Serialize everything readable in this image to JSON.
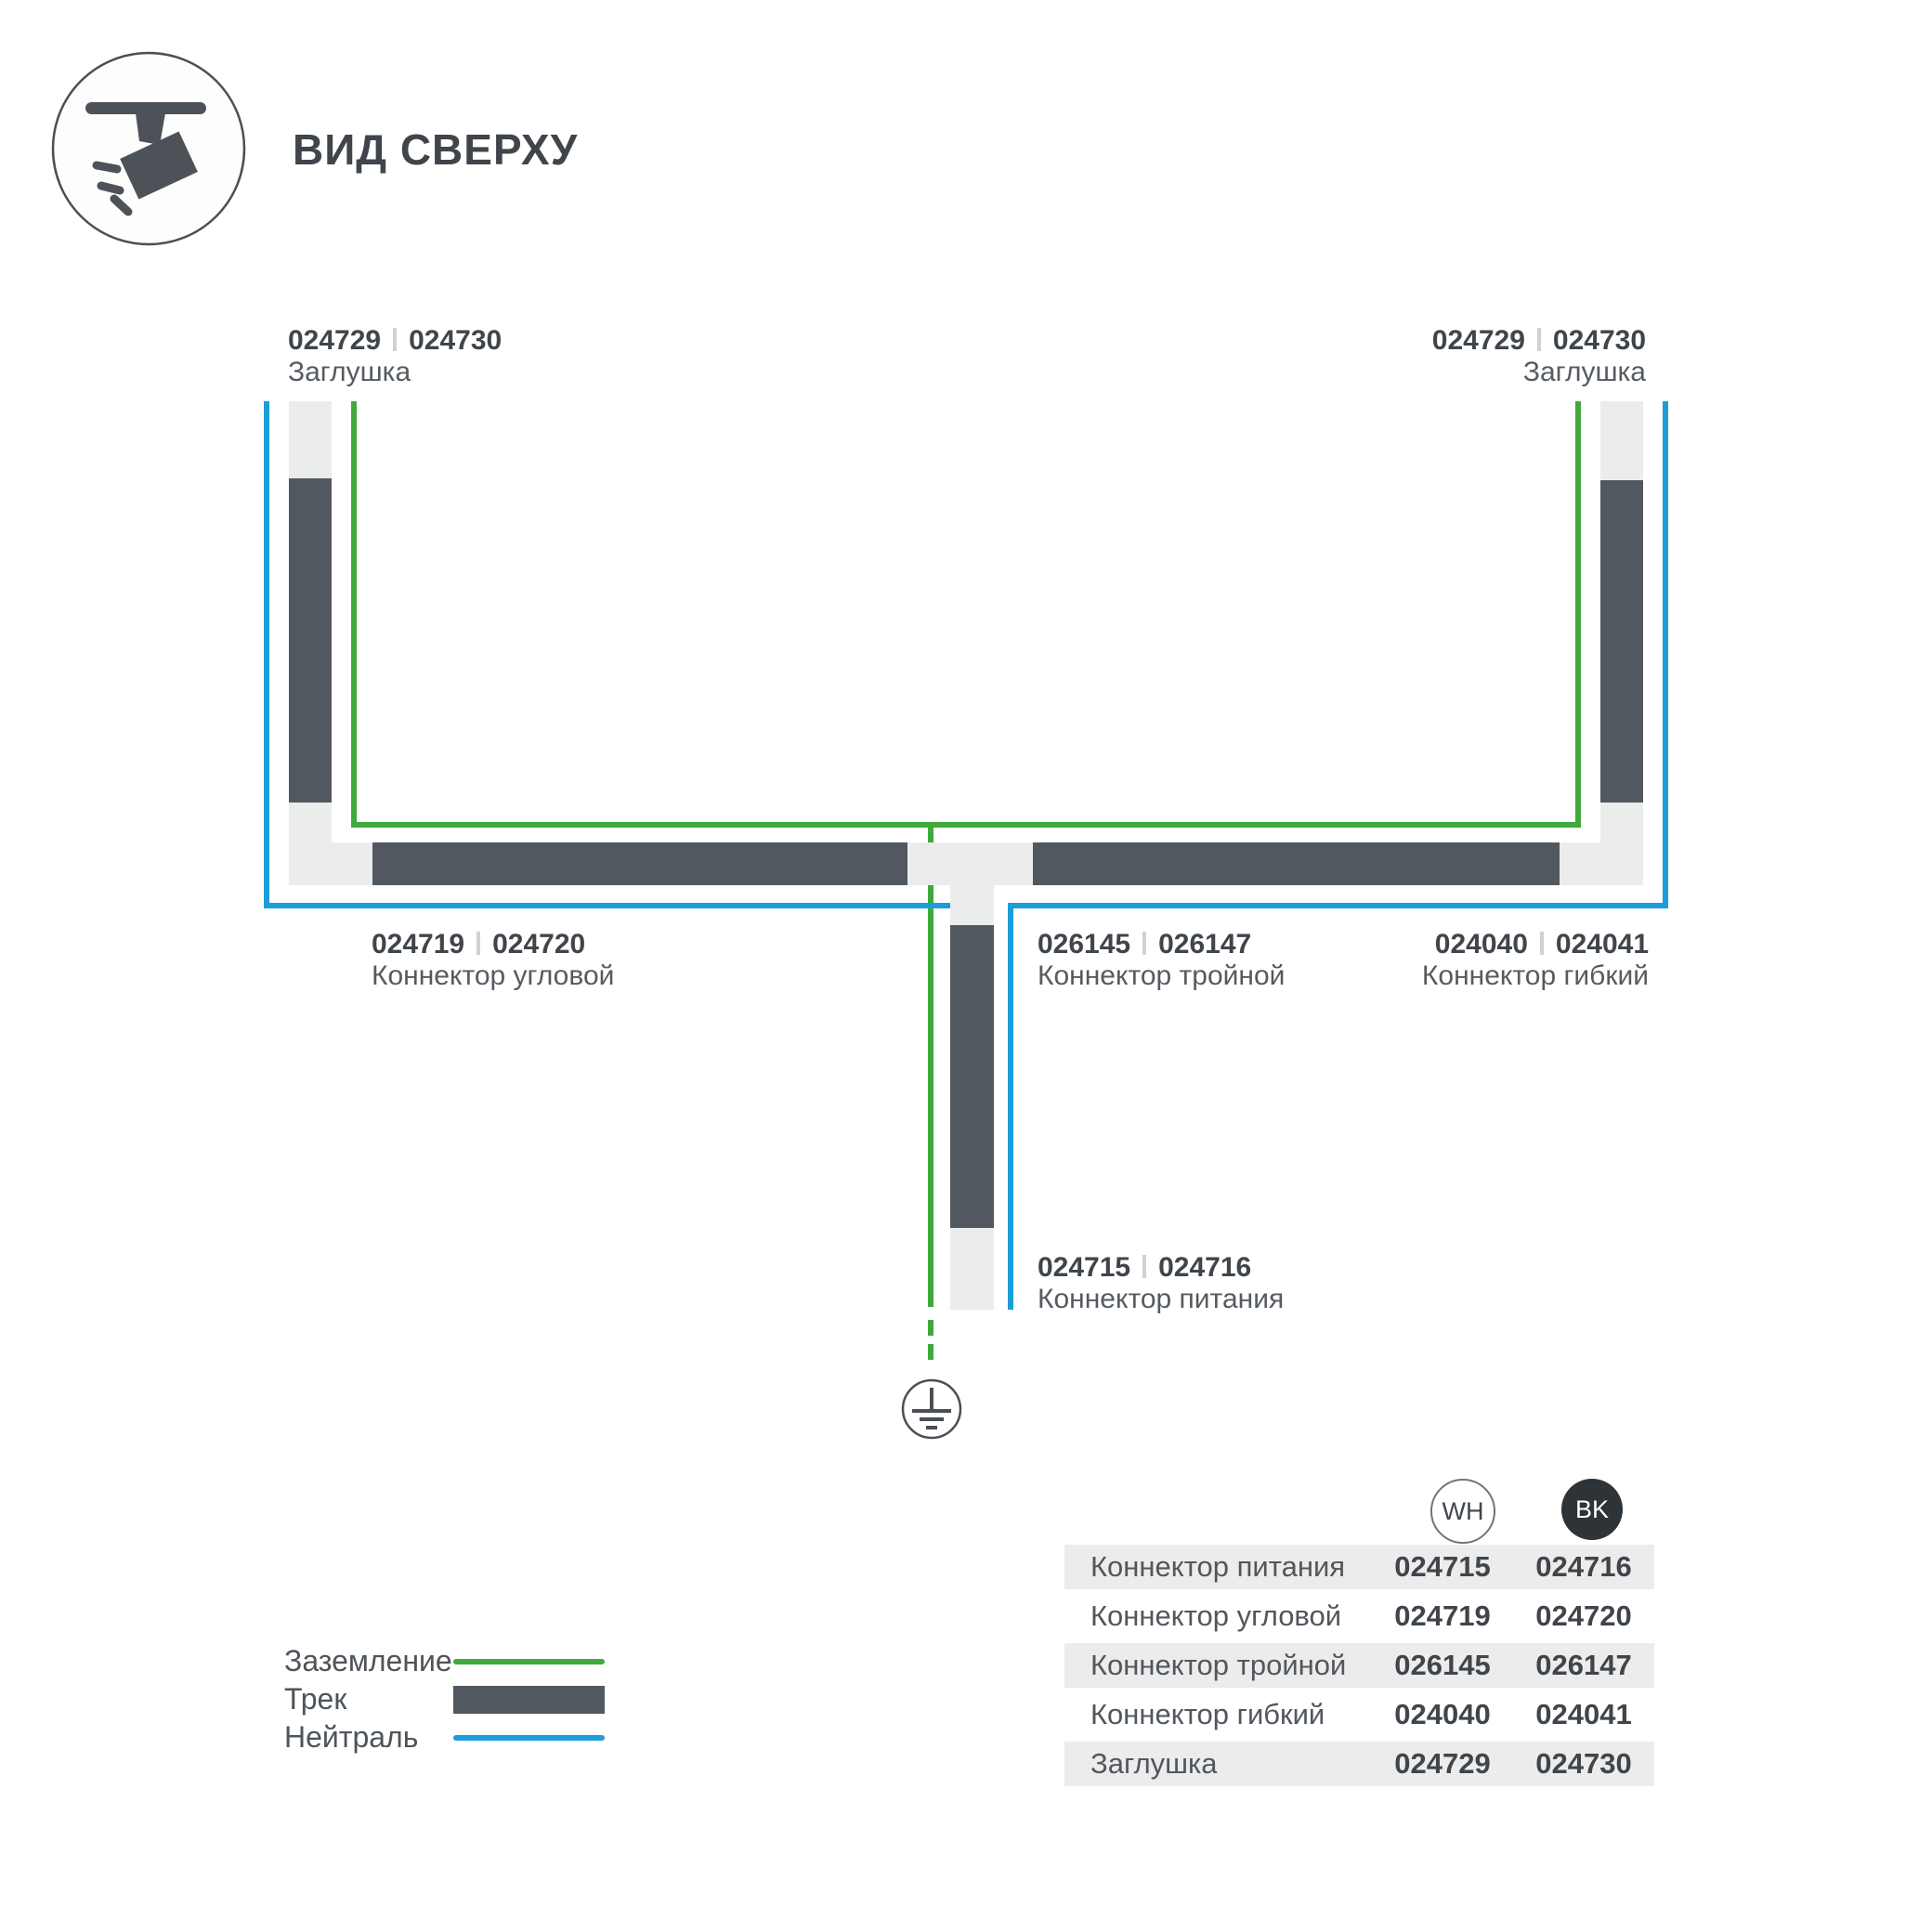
{
  "header": {
    "title": "ВИД СВЕРХУ",
    "icon": "track-spotlight-icon"
  },
  "diagram": {
    "labels": {
      "endcap_left": {
        "code_wh": "024729",
        "code_bk": "024730",
        "name": "Заглушка"
      },
      "endcap_right": {
        "code_wh": "024729",
        "code_bk": "024730",
        "name": "Заглушка"
      },
      "corner": {
        "code_wh": "024719",
        "code_bk": "024720",
        "name": "Коннектор угловой"
      },
      "triple": {
        "code_wh": "026145",
        "code_bk": "026147",
        "name": "Коннектор тройной"
      },
      "flex": {
        "code_wh": "024040",
        "code_bk": "024041",
        "name": "Коннектор гибкий"
      },
      "power": {
        "code_wh": "024715",
        "code_bk": "024716",
        "name": "Коннектор питания"
      }
    },
    "ground_symbol": "earth-ground-icon"
  },
  "legend": {
    "items": [
      {
        "label": "Заземление",
        "type": "ground"
      },
      {
        "label": "Трек",
        "type": "track"
      },
      {
        "label": "Нейтраль",
        "type": "neutral"
      }
    ]
  },
  "table": {
    "columns": [
      {
        "id": "wh",
        "label": "WH"
      },
      {
        "id": "bk",
        "label": "BK"
      }
    ],
    "rows": [
      {
        "name": "Коннектор питания",
        "wh": "024715",
        "bk": "024716"
      },
      {
        "name": "Коннектор угловой",
        "wh": "024719",
        "bk": "024720"
      },
      {
        "name": "Коннектор тройной",
        "wh": "026145",
        "bk": "026147"
      },
      {
        "name": "Коннектор гибкий",
        "wh": "024040",
        "bk": "024041"
      },
      {
        "name": "Заглушка",
        "wh": "024729",
        "bk": "024730"
      }
    ]
  },
  "colors": {
    "ground": "#3faa3c",
    "neutral": "#1b9dd9",
    "track_dark": "#515860",
    "track_light": "#ebecec",
    "text_dark": "#3f454b",
    "text_gray": "#555b61",
    "row_bg": "#ececec",
    "bk_fill": "#2e3337"
  }
}
